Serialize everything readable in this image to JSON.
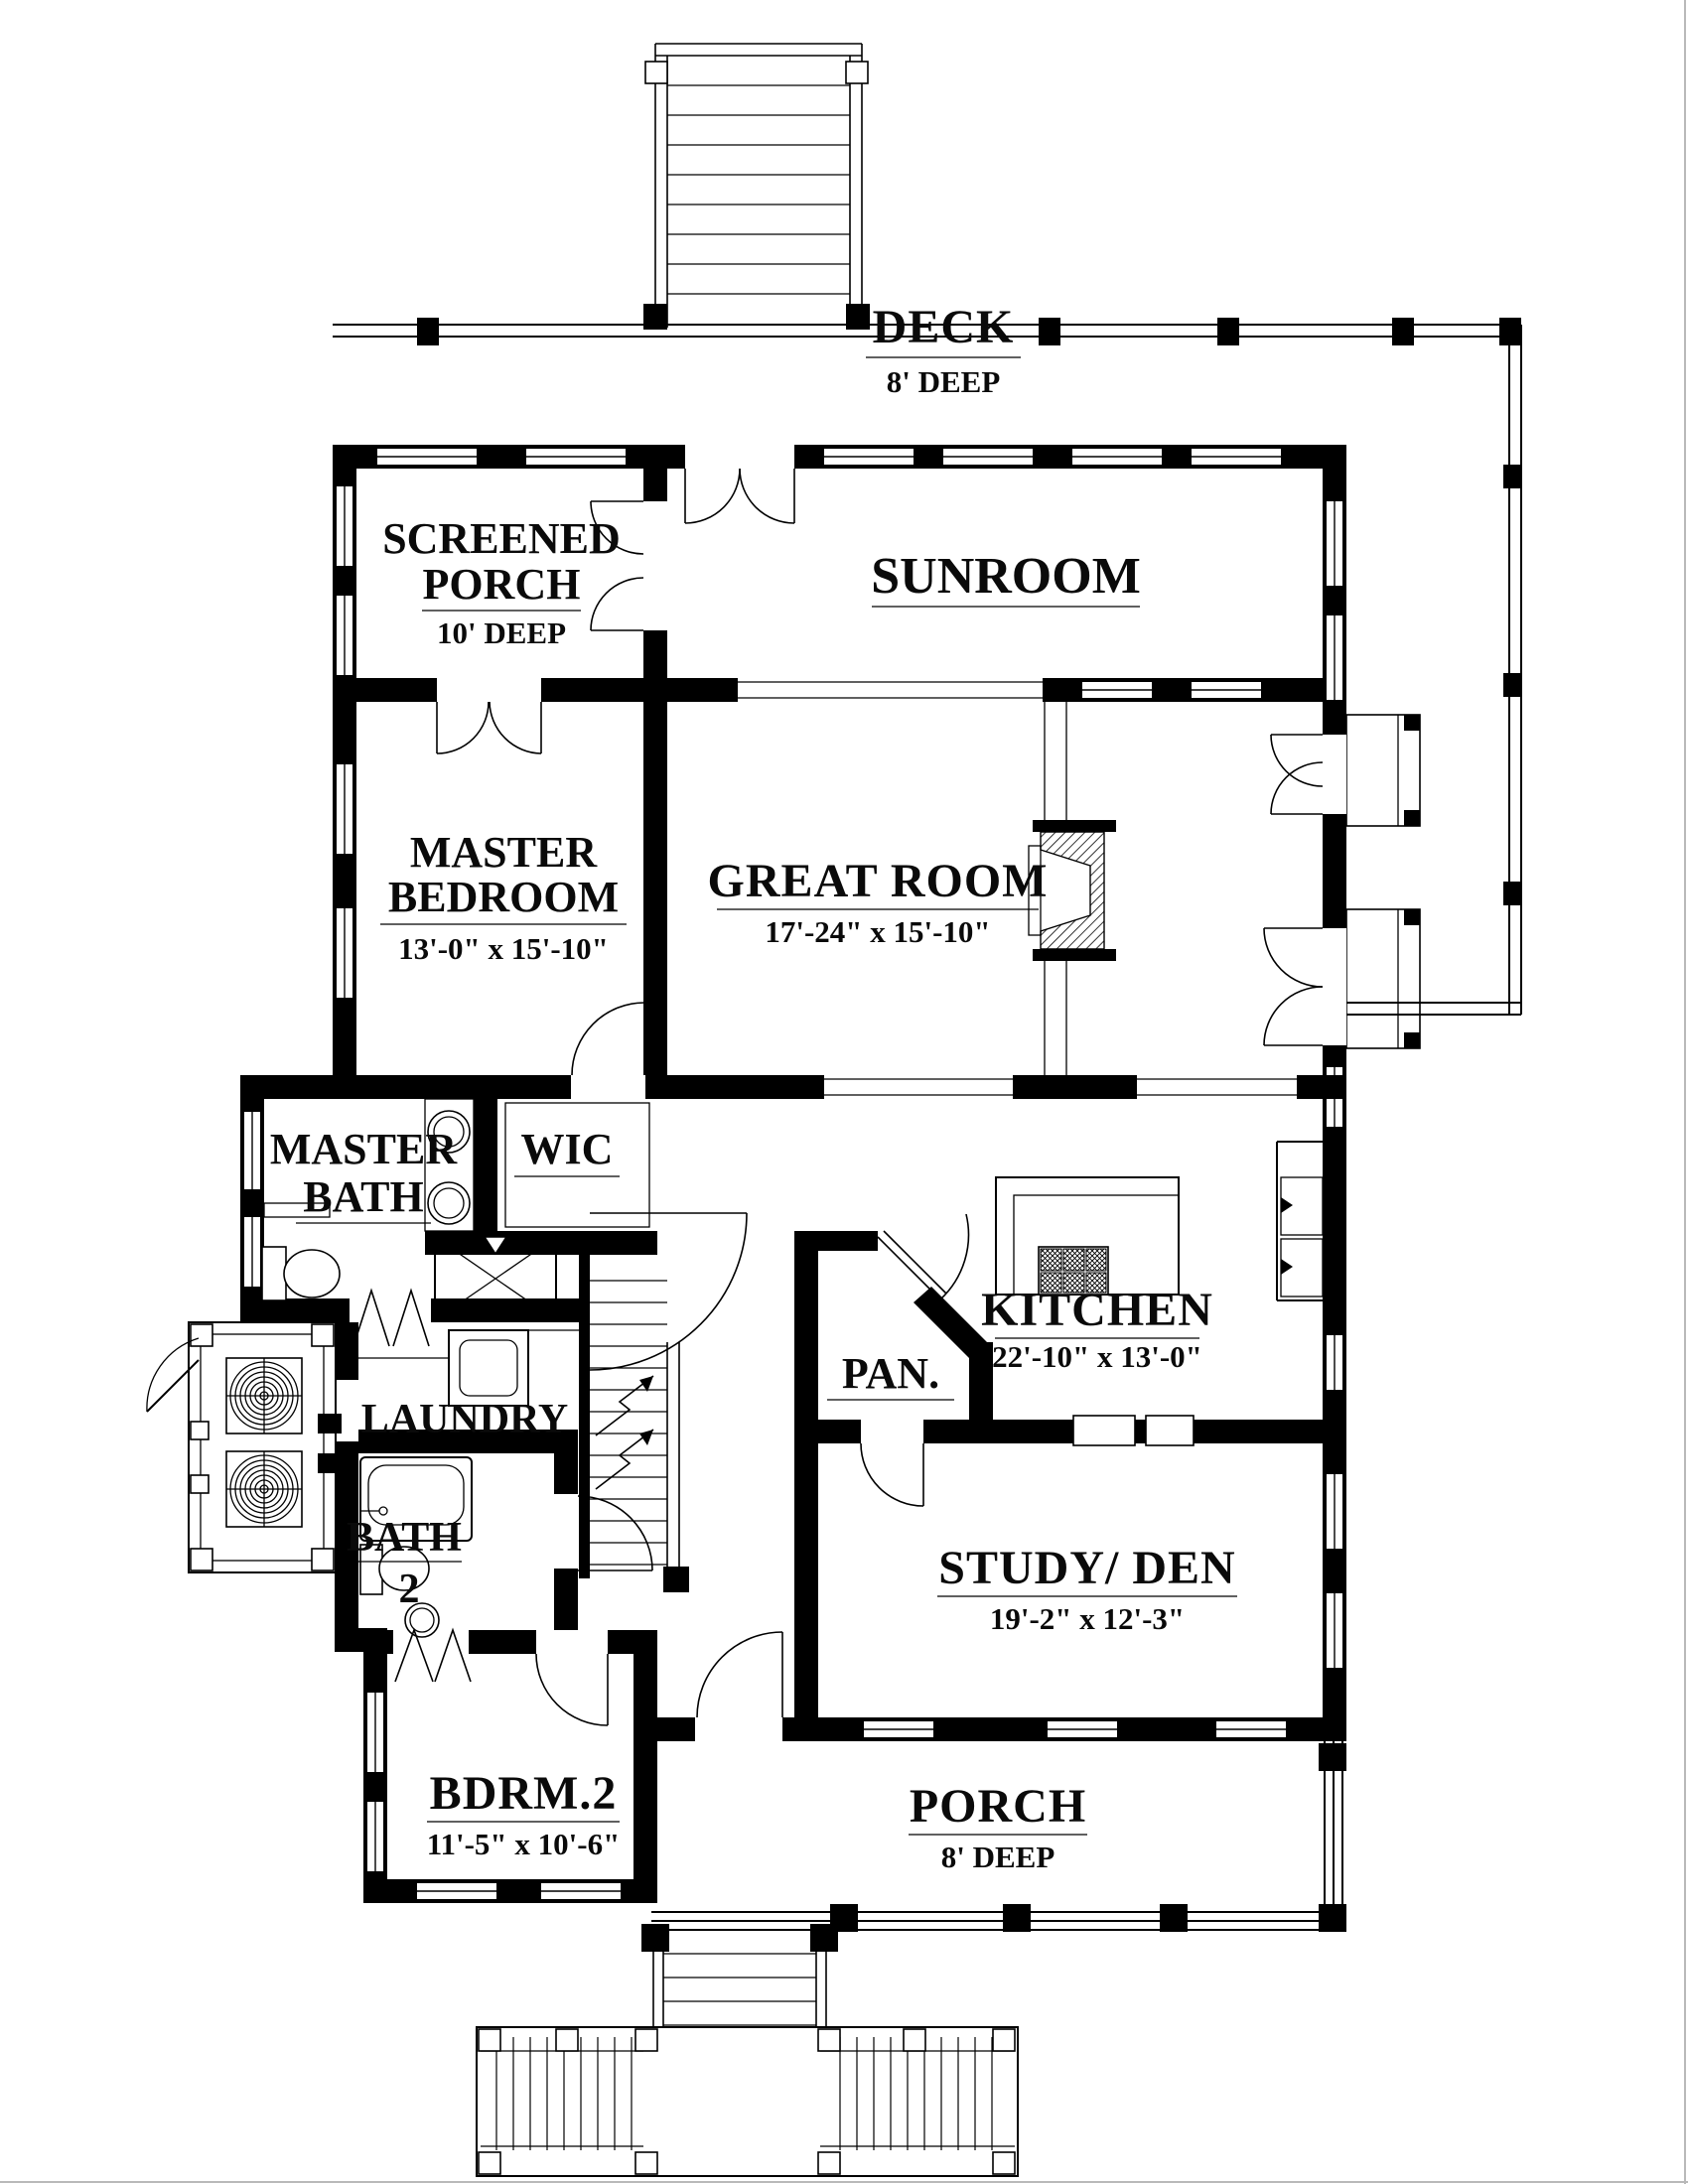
{
  "document": {
    "type": "floor-plan",
    "style": "black-and-white architectural drawing"
  },
  "rooms": {
    "deck": {
      "name": "DECK",
      "size": "8' DEEP"
    },
    "screened_porch": {
      "name_line1": "SCREENED",
      "name_line2": "PORCH",
      "size": "10' DEEP"
    },
    "sunroom": {
      "name": "SUNROOM"
    },
    "master_bedroom": {
      "name_line1": "MASTER",
      "name_line2": "BEDROOM",
      "size": "13'-0\" x 15'-10\""
    },
    "great_room": {
      "name": "GREAT ROOM",
      "size": "17'-24\" x 15'-10\""
    },
    "master_bath": {
      "name_line1": "MASTER",
      "name_line2": "BATH"
    },
    "wic": {
      "name": "WIC"
    },
    "kitchen": {
      "name": "KITCHEN",
      "size": "22'-10\" x 13'-0\""
    },
    "pantry": {
      "name": "PAN."
    },
    "laundry": {
      "name": "LAUNDRY"
    },
    "bath_2": {
      "name_line1": "BATH",
      "name_line2": "2"
    },
    "study_den": {
      "name": "STUDY/ DEN",
      "size": "19'-2\" x 12'-3\""
    },
    "bedroom_2": {
      "name": "BDRM.2",
      "size": "11'-5\" x 10'-6\""
    },
    "porch": {
      "name": "PORCH",
      "size": "8' DEEP"
    }
  },
  "colors": {
    "ink": "#000000",
    "paper": "#ffffff"
  }
}
